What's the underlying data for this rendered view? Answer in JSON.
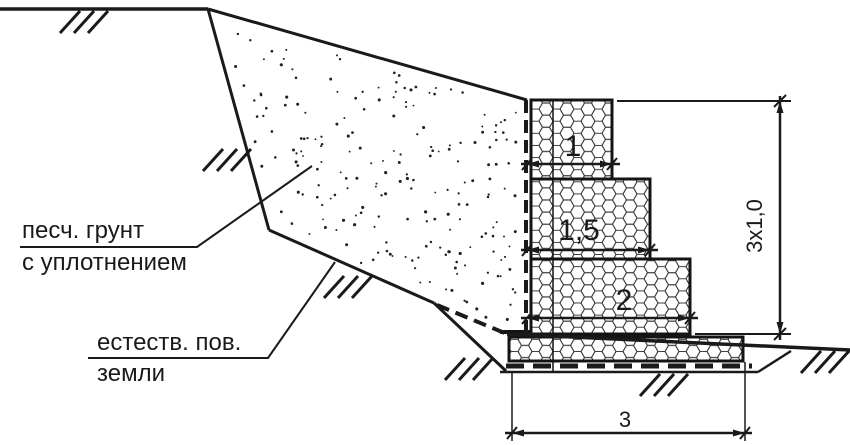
{
  "annotations": {
    "backfill": {
      "line1": "песч. грунт",
      "line2": "с уплотнением"
    },
    "natural_ground": {
      "line1": "естеств. пов.",
      "line2": "земли"
    }
  },
  "dimensions": {
    "gabion_row_1_width": "1",
    "gabion_row_2_width": "1,5",
    "gabion_row_3_width": "2",
    "base_width": "3",
    "wall_height": "3x1,0"
  },
  "legend": {
    "hex_pattern": "gabion-mesh",
    "stipple_pattern": "sand-backfill",
    "hatch_pattern": "ground-surface-ticks"
  },
  "colors": {
    "line": "#1a1a1a",
    "background": "#ffffff"
  }
}
